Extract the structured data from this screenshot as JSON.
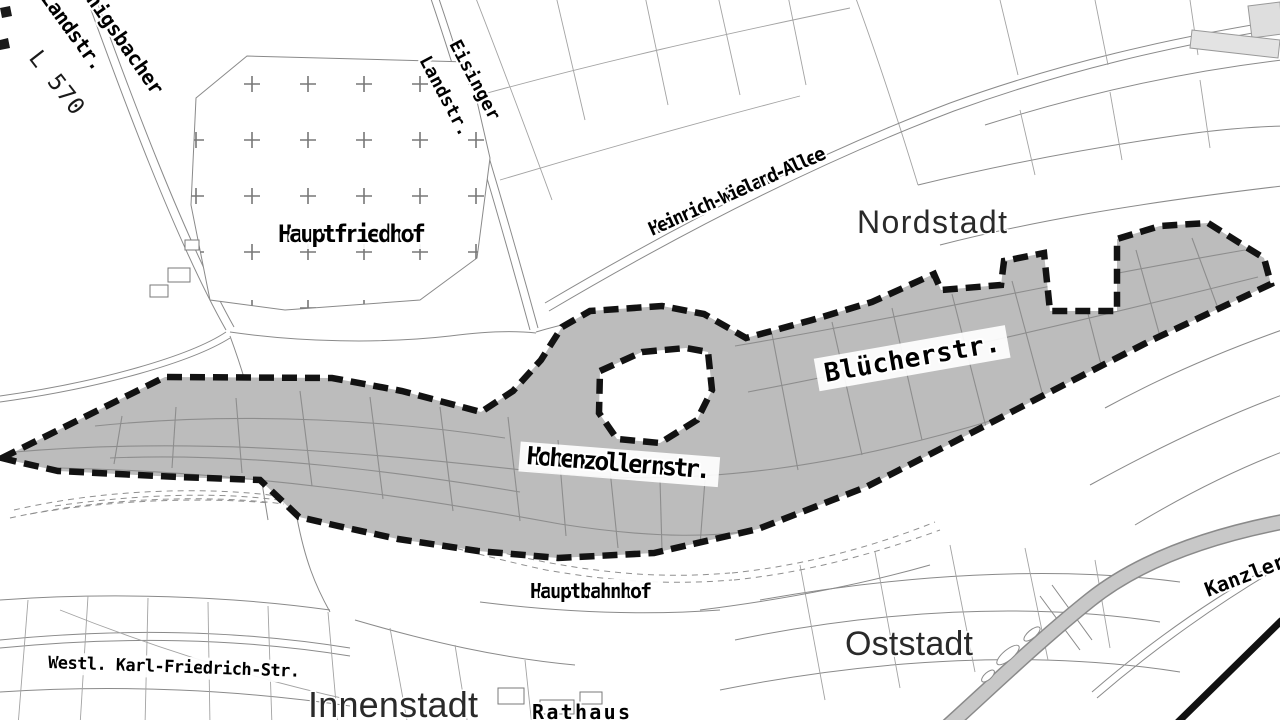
{
  "map": {
    "district_labels": {
      "nordstadt": "Nordstadt",
      "innenstadt": "Innenstadt",
      "oststadt": "Oststadt"
    },
    "street_labels": {
      "l570": "L 570",
      "koenigsbacher_line1": "Königsbacher",
      "koenigsbacher_line2": "Landstr.",
      "eisinger_line1": "Eisinger",
      "eisinger_line2": "Landstr.",
      "hauptfriedhof": "Hauptfriedhof",
      "heinrich_wieland_allee": "Heinrich-Wieland-Allee",
      "bluecherstr": "Blücherstr.",
      "hohenzollernstr": "Hohenzollernstr.",
      "hauptbahnhof": "Hauptbahnhof",
      "westl_karl_friedrich_str": "Westl. Karl-Friedrich-Str.",
      "rathaus": "Rathaus",
      "kanzlerstr": "Kanzlerstr."
    },
    "colors": {
      "background": "#ffffff",
      "street_line": "#8a8a8a",
      "highlight_area_fill": "#bcbcbc",
      "boundary_dash": "#121212",
      "river_fill": "#c8c8c8",
      "cemetery_cross": "#777777"
    }
  }
}
